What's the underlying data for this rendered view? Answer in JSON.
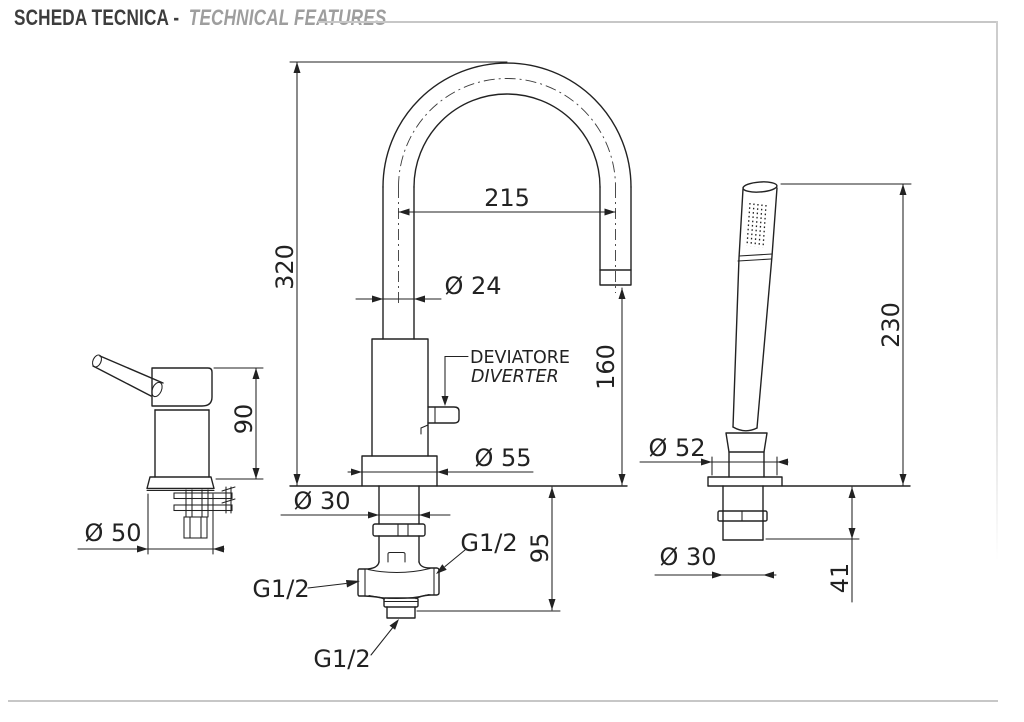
{
  "header": {
    "title_primary": "SCHEDA TECNICA -",
    "title_secondary": "TECHNICAL FEATURES"
  },
  "colors": {
    "linework": "#222222",
    "rule_gray": "#c7c7c7",
    "title_primary": "#3d3d3d",
    "title_secondary": "#9e9e9e"
  },
  "drawings": {
    "handle": {
      "height": "90",
      "base_diameter": "Ø 50"
    },
    "spout": {
      "total_height": "320",
      "reach": "215",
      "pipe_diameter": "Ø 24",
      "outlet_height": "160",
      "base_diameter": "Ø 55",
      "shank_diameter": "Ø 30",
      "underdeck_depth": "95",
      "diverter_label_it": "DEVIATORE",
      "diverter_label_en": "DIVERTER",
      "thread_left": "G1/2",
      "thread_right": "G1/2",
      "thread_bottom": "G1/2"
    },
    "handshower": {
      "height": "230",
      "holder_diameter": "Ø 52",
      "shank_diameter": "Ø 30",
      "underdeck_depth": "41"
    }
  }
}
